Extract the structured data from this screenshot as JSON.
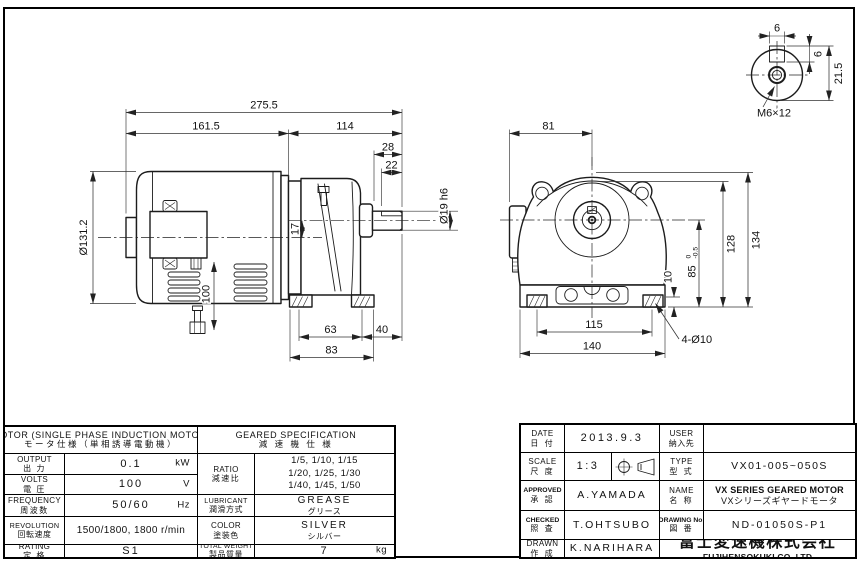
{
  "side_view": {
    "overall_length": "275.5",
    "motor_length": "161.5",
    "gearbox_length": "114",
    "shaft_projection": "28",
    "key_length": "22",
    "shaft_dia": "Ø19 h6",
    "motor_dia": "Ø131.2",
    "axis_offset": "17",
    "lead_length": "100",
    "foot_pitch": "63",
    "foot_to_shaft_end": "40",
    "base_length": "83"
  },
  "front_view": {
    "box_to_center": "81",
    "overall_height": "134",
    "body_height": "128",
    "shaft_height": "85",
    "shaft_height_tol_upper": "0",
    "shaft_height_tol_lower": "-0.5",
    "pad_height": "10",
    "foot_pitch": "115",
    "base_width": "140",
    "mount_holes": "4-Ø10"
  },
  "detail_view": {
    "key_width": "6",
    "key_height": "6",
    "key_top_dim": "21.5",
    "tap_hole": "M6×12"
  },
  "spec_table": {
    "motor": {
      "title_en": "MOTOR (SINGLE PHASE INDUCTION MOTOR)",
      "title_jp": "モータ仕様（単相誘導電動機）",
      "rows": [
        {
          "label_en": "OUTPUT",
          "label_jp": "出 力",
          "value": "0.1",
          "unit": "kW"
        },
        {
          "label_en": "VOLTS",
          "label_jp": "電 圧",
          "value": "100",
          "unit": "V"
        },
        {
          "label_en": "FREQUENCY",
          "label_jp": "周波数",
          "value": "50/60",
          "unit": "Hz"
        },
        {
          "label_en": "REVOLUTION",
          "label_jp": "回転速度",
          "value": "1500/1800, 1800 r/min",
          "unit": ""
        },
        {
          "label_en": "RATING",
          "label_jp": "定 格",
          "value": "S1",
          "unit": ""
        }
      ]
    },
    "geared": {
      "title_en": "GEARED SPECIFICATION",
      "title_jp": "減 速 機 仕 様",
      "ratio_label_en": "RATIO",
      "ratio_label_jp": "減速比",
      "ratio_lines": [
        "1/5, 1/10, 1/15",
        "1/20, 1/25, 1/30",
        "1/40, 1/45, 1/50"
      ],
      "lubricant_label_en": "LUBRICANT",
      "lubricant_label_jp": "潤滑方式",
      "lubricant_value_en": "GREASE",
      "lubricant_value_jp": "グリース",
      "color_label_en": "COLOR",
      "color_label_jp": "塗装色",
      "color_value_en": "SILVER",
      "color_value_jp": "シルバー",
      "weight_label_en": "TOTAL WEIGHT",
      "weight_label_jp": "製品質量",
      "weight_value": "7",
      "weight_unit": "kg"
    }
  },
  "title_block": {
    "date_label_en": "DATE",
    "date_label_jp": "日 付",
    "date_value": "2013.9.3",
    "user_label_en": "USER",
    "user_label_jp": "納入先",
    "user_value": "",
    "scale_label_en": "SCALE",
    "scale_label_jp": "尺 度",
    "scale_value": "1:3",
    "type_label_en": "TYPE",
    "type_label_jp": "型 式",
    "type_value": "VX01-005~050S",
    "approved_label_en": "APPROVED",
    "approved_label_jp": "承 認",
    "approved_value": "A.YAMADA",
    "name_label_en": "NAME",
    "name_label_jp": "名 称",
    "name_value_en": "VX SERIES GEARED MOTOR",
    "name_value_jp": "VXシリーズギヤードモータ",
    "checked_label_en": "CHECKED",
    "checked_label_jp": "照 査",
    "checked_value": "T.OHTSUBO",
    "drawing_no_label_en": "DRAWING No.",
    "drawing_no_label_jp": "図 番",
    "drawing_no_value": "ND-01050S-P1",
    "drawn_label_en": "DRAWN",
    "drawn_label_jp": "作 成",
    "drawn_value": "K.NARIHARA",
    "company_jp": "富士変速機株式会社",
    "company_en": "FUJIHENSOKUKI CO.,LTD"
  }
}
